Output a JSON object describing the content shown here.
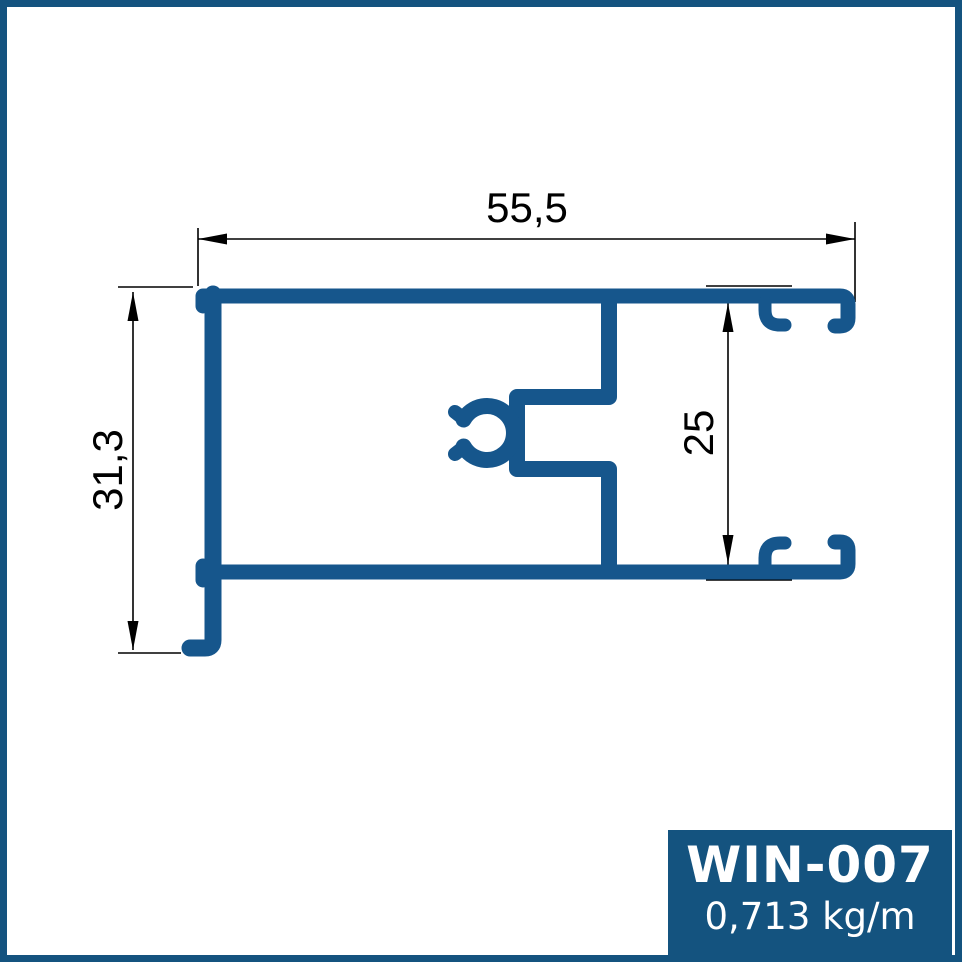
{
  "drawing": {
    "type": "aluminium-profile-cross-section",
    "dimensions": {
      "width_label": "55,5",
      "height_label": "31,3",
      "inner_height_label": "25"
    },
    "colors": {
      "profile_fill": "#16568C",
      "dimension_lines": "#000000",
      "frame_border": "#14537F"
    }
  },
  "label_box": {
    "code": "WIN-007",
    "weight": "0,713 kg/m",
    "background": "#14537F",
    "text_color": "#FFFFFF"
  }
}
